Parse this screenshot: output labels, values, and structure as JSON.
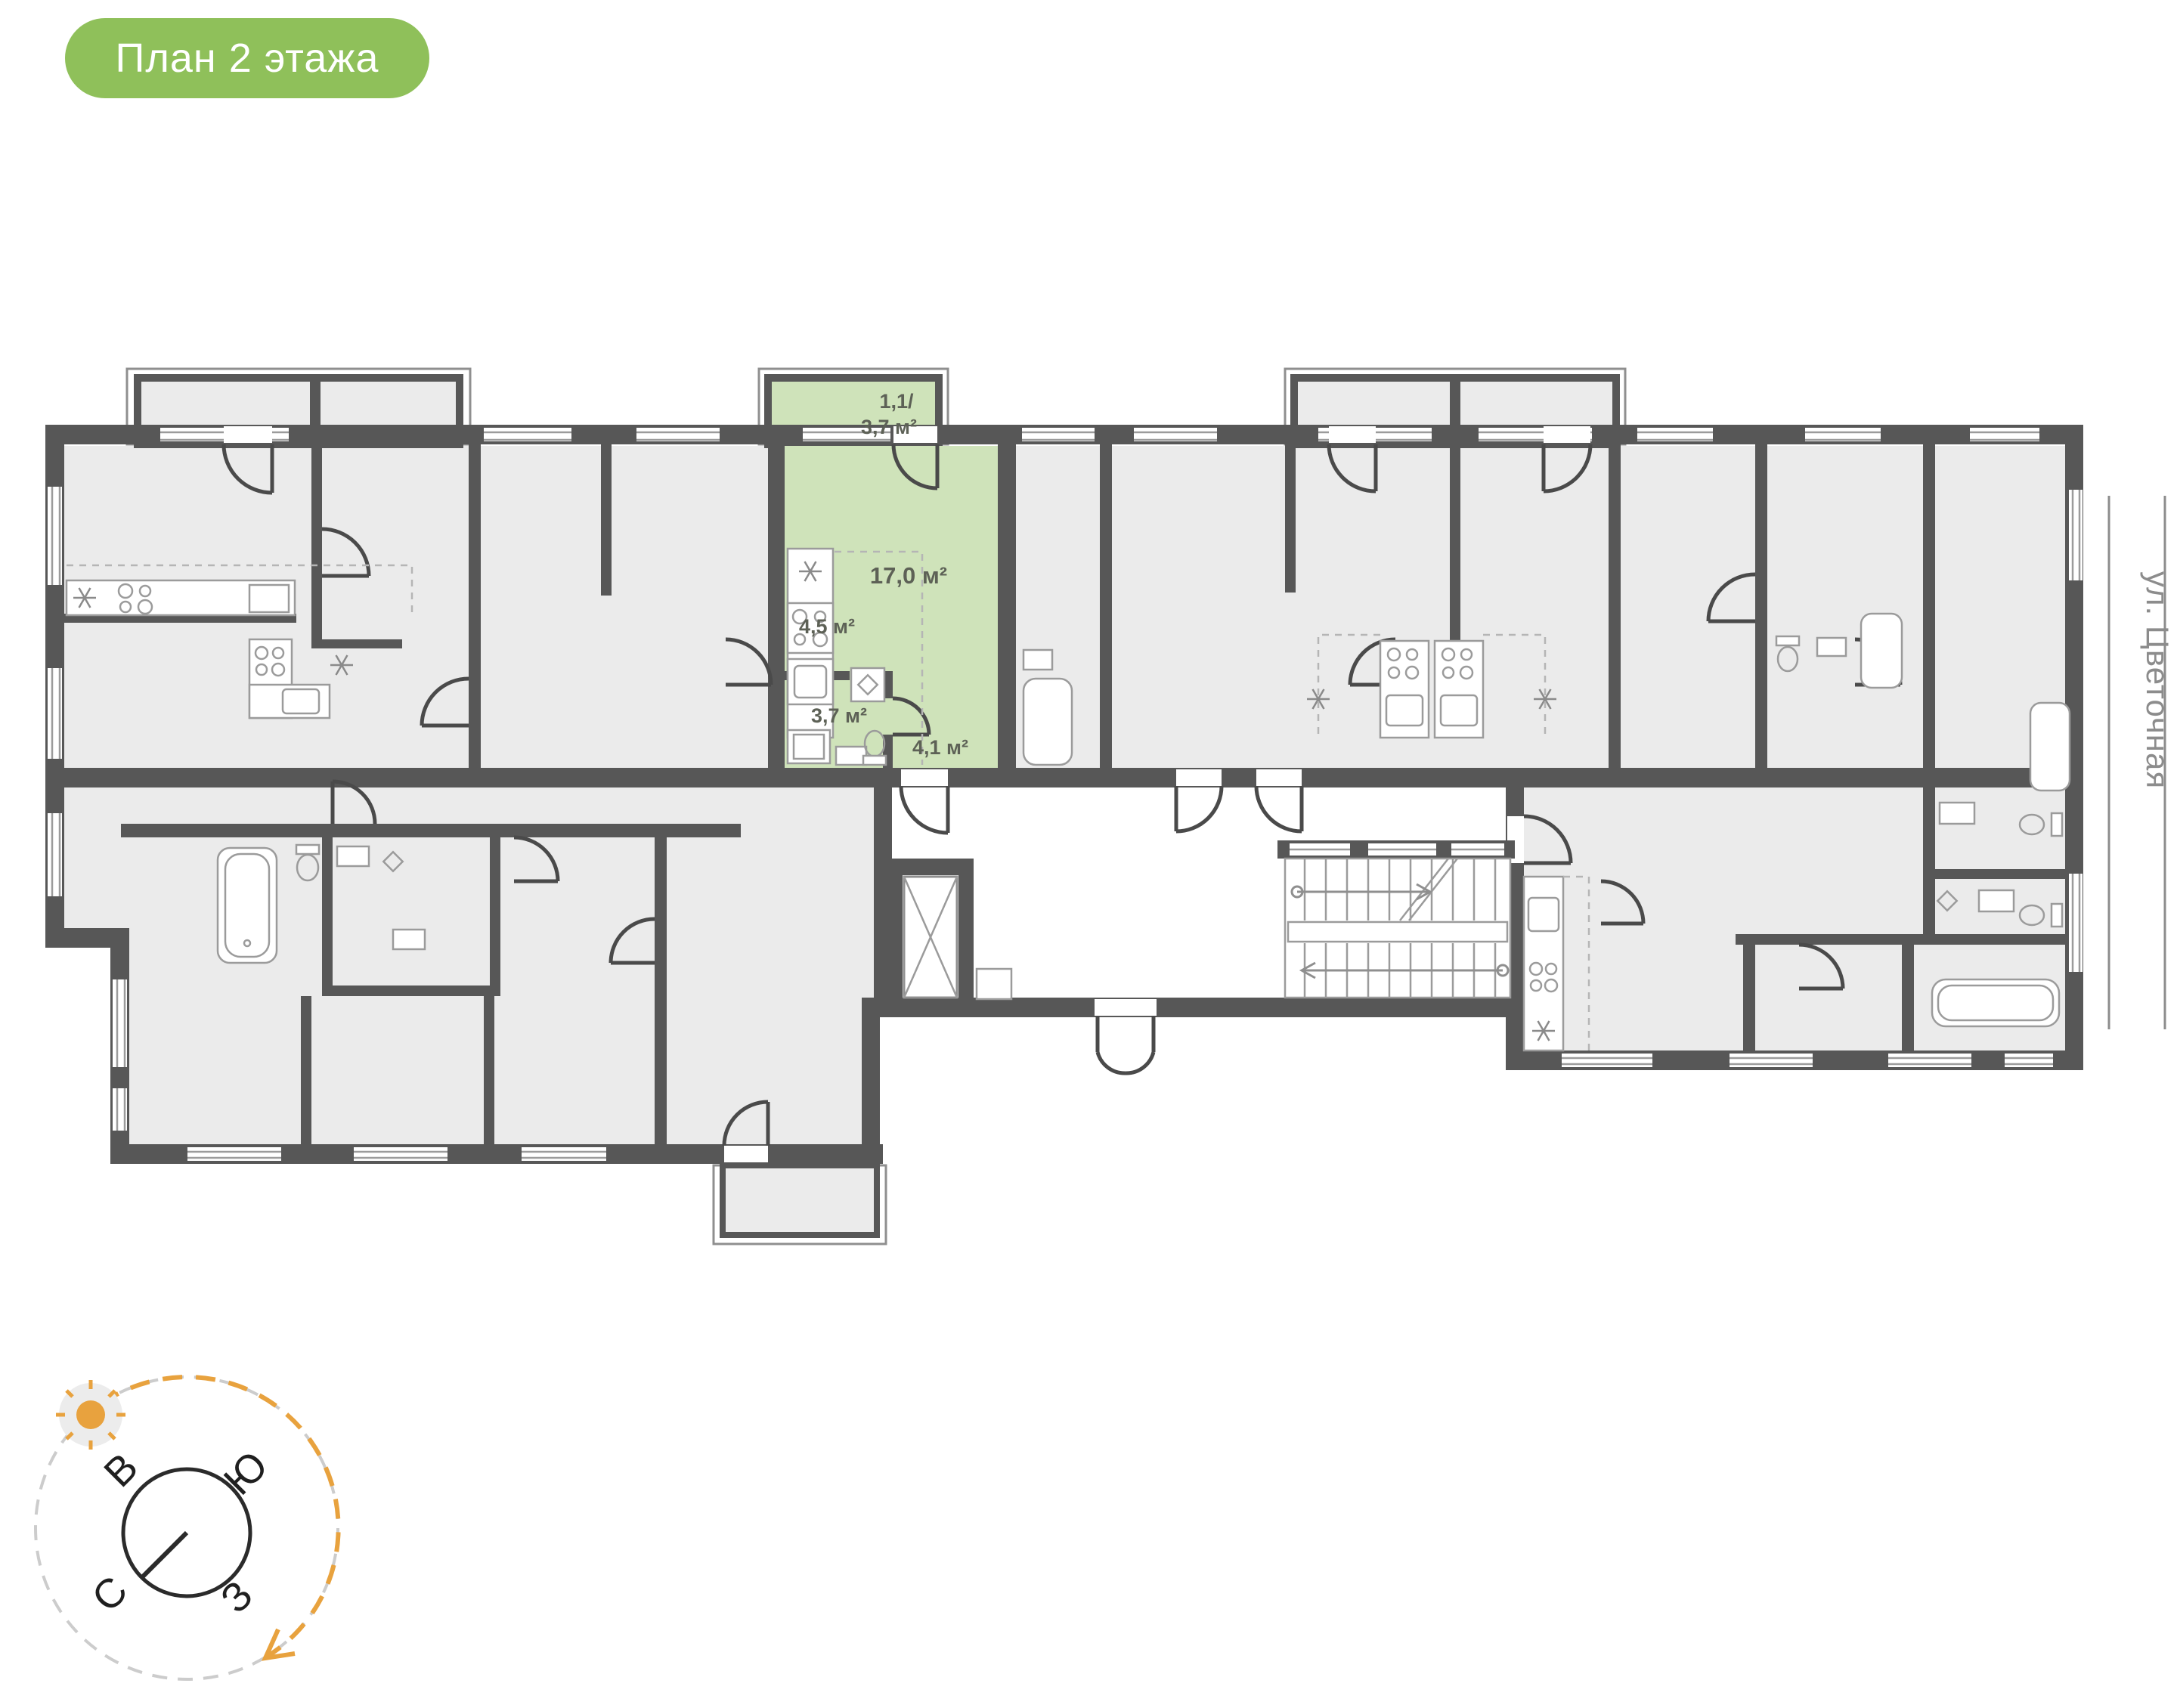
{
  "badge": {
    "label": "План 2 этажа"
  },
  "street": {
    "label": "ул. Цветочная"
  },
  "compass": {
    "east": "В",
    "south": "Ю",
    "north": "С",
    "west": "З"
  },
  "unit": {
    "labels": {
      "balcony_line1": "1,1/",
      "balcony_line2": "3,7 м²",
      "living": "17,0 м²",
      "kitchen": "4,5 м²",
      "bathroom": "3,7 м²",
      "hall": "4,1 м²"
    }
  },
  "colors": {
    "badge_green": "#8fc05a",
    "unit_green": "#cfe3ba",
    "wall_gray": "#575757",
    "room_gray": "#ebebeb",
    "accent_orange": "#e8a23e"
  }
}
